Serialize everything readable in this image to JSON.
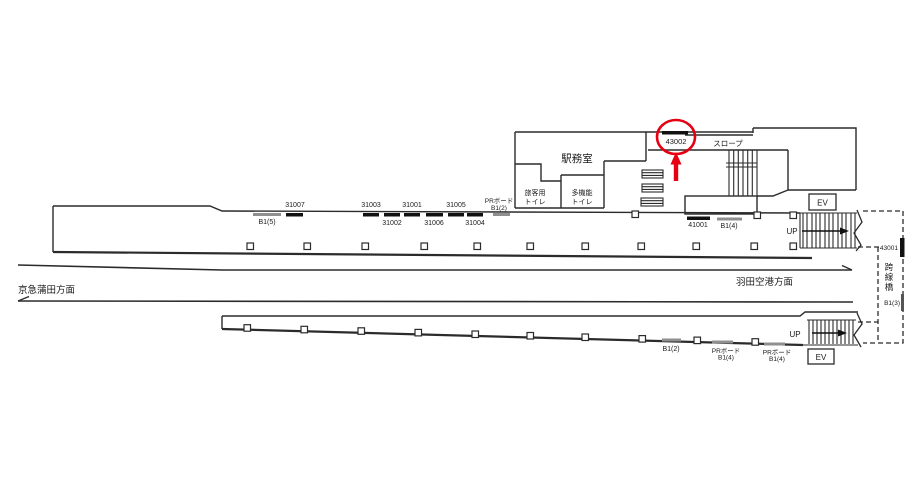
{
  "station_map": {
    "building": {
      "office": "駅務室",
      "toilet_passenger_line1": "旅客用",
      "toilet_passenger_line2": "トイレ",
      "toilet_multi_line1": "多機能",
      "toilet_multi_line2": "トイレ",
      "slope": "スロープ"
    },
    "highlight": {
      "board_id": "43002",
      "color": "#e60012"
    },
    "upper_platform": {
      "b1_5": "B1(5)",
      "board_31007": "31007",
      "board_31003": "31003",
      "board_31002": "31002",
      "board_31001": "31001",
      "board_31006": "31006",
      "board_31005": "31005",
      "board_31004": "31004",
      "pr_board": "PRボード",
      "b1_2": "B1(2)",
      "board_41001": "41001",
      "b1_4": "B1(4)",
      "up": "UP",
      "ev": "EV"
    },
    "tracks": {
      "left_direction": "京急蒲田方面",
      "right_direction": "羽田空港方面"
    },
    "lower_platform": {
      "b1_2": "B1(2)",
      "pr_board": "PRボード",
      "b1_4": "B1(4)",
      "up": "UP",
      "ev": "EV"
    },
    "footbridge": {
      "board_43001": "43001",
      "chars": [
        "跨",
        "線",
        "橋"
      ],
      "b1_3": "B1(3)"
    },
    "colors": {
      "line": "#2b2b2b",
      "board_black": "#111111",
      "board_gray": "#8f8f8f"
    }
  }
}
